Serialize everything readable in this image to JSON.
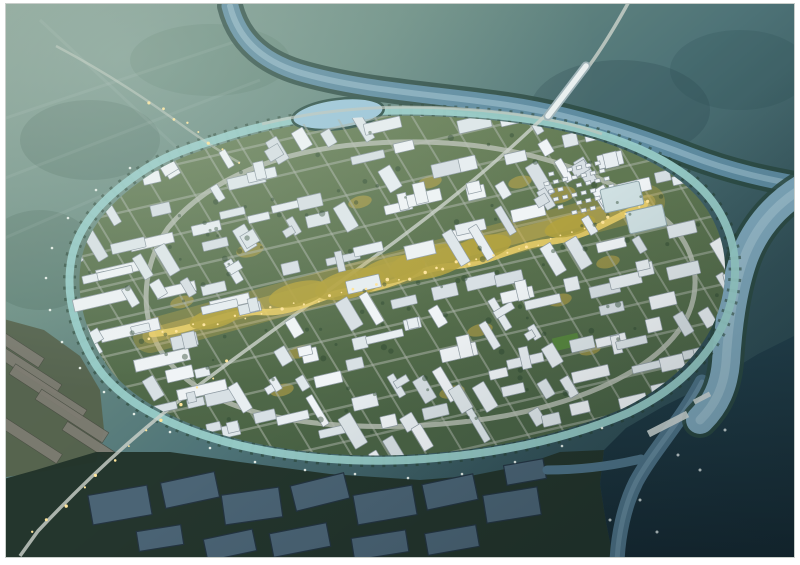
{
  "image": {
    "type": "architectural aerial rendering (photo-style, no text or UI elements visible)",
    "alt": "Oblique aerial dusk rendering of a master-planned city district: an oval island of dense white mid-rise blocks ringed by a canal and ring road, a glowing golden landscaped axis through the center, a winding river with a lake to the north, hazy green farmland to the northwest, a straight highway crossing diagonally with a bridge, greenhouse strips to the southwest, dark aquaculture ponds to the south, and a dark river delta with a pier to the southeast.",
    "visible_text": "none"
  },
  "colors": {
    "frame": "#ffffff",
    "haze_nw": "#86a093",
    "haze_mid": "#5d8180",
    "water_ne": "#36575e",
    "water_se": "#1e3741",
    "river": "#5e8ba0",
    "river_light": "#9dc0cd",
    "river_bank": "#2b4a42",
    "channel": "#4e7388",
    "canal": "#98ccc8",
    "city_green_n": "#6b8259",
    "city_green_s": "#4a6345",
    "building": "#e8eef1",
    "building_shadow": "#8f9ba3",
    "road": "#aab2a7",
    "ring_road": "#b6bdb2",
    "axis_gold": "#c9ab45",
    "axis_bright": "#ecd06a",
    "lawn_olive": "#b3a23e",
    "tree": "#2c4731",
    "pond": "#4e6779",
    "pond_dark": "#243442",
    "field_gray": "#7e7c72",
    "land_dark": "#22332a",
    "light_dot": "#ffe59b"
  },
  "scene": {
    "regions": [
      {
        "name": "farmland-haze-northwest",
        "description": "hazy sage-green fields fading into mist"
      },
      {
        "name": "north-river",
        "description": "steel-blue river winding left-to-right above the city, with a small lake at the city's north edge"
      },
      {
        "name": "city-island",
        "description": "oval planned district of white low-rise blocks on a rotated street grid"
      },
      {
        "name": "golden-axis",
        "description": "illuminated gold-and-olive landscaped spine crossing the city diagonally"
      },
      {
        "name": "ring-road-and-canal",
        "description": "light gray loop road inside a teal canal ring with street lamps"
      },
      {
        "name": "diagonal-highway",
        "description": "straight lit highway from top-right, bridging the river, exiting bottom-left"
      },
      {
        "name": "greenhouse-fields-southwest",
        "description": "gray diagonal greenhouse strips on olive ground"
      },
      {
        "name": "aquaculture-ponds-south",
        "description": "slate-blue rectangular ponds amid dark vegetation"
      },
      {
        "name": "river-delta-southeast",
        "description": "dark water with a lighter channel, small pier and boats"
      }
    ],
    "render": {
      "seed": 11,
      "city_center": [
        402,
        288
      ],
      "grid_angle_u": -13,
      "grid_angle_v": 59,
      "grid_halfU": 360,
      "grid_stepU": 27,
      "grid_halfV": 175,
      "grid_stepV": 31,
      "skip_chance": 0.3,
      "axis_line_pt": [
        400,
        278
      ],
      "axis_normal": [
        0.26,
        0.966
      ],
      "axis_gap": 17,
      "building_fills": [
        "#e8eef1",
        "#dfe7ea",
        "#f0f4f6",
        "#d8e0e4"
      ],
      "road_lines_u": {
        "count": 13,
        "spacing": 36,
        "len": 400,
        "width": 2.4
      },
      "road_lines_v": {
        "count": 23,
        "spacing": 34,
        "len": 250,
        "width": 2.0
      },
      "tree_count": 170,
      "axis_path": [
        [
          150,
          336
        ],
        [
          262,
          312
        ],
        [
          358,
          290
        ],
        [
          452,
          266
        ],
        [
          548,
          242
        ],
        [
          648,
          202
        ]
      ],
      "axis_light_count": 42,
      "axis_patches": [
        [
          215,
          318,
          26,
          10
        ],
        [
          298,
          294,
          30,
          12
        ],
        [
          392,
          270,
          34,
          13
        ],
        [
          482,
          248,
          30,
          12
        ],
        [
          570,
          226,
          26,
          10
        ],
        [
          430,
          262,
          42,
          16
        ],
        [
          350,
          284,
          36,
          14
        ]
      ],
      "gold_pockets": [
        [
          250,
          250,
          14,
          7
        ],
        [
          182,
          302,
          12,
          6
        ],
        [
          300,
          352,
          13,
          6
        ],
        [
          480,
          330,
          13,
          6
        ],
        [
          560,
          300,
          12,
          6
        ],
        [
          608,
          262,
          12,
          6
        ],
        [
          520,
          182,
          12,
          6
        ],
        [
          430,
          182,
          12,
          6
        ],
        [
          360,
          202,
          12,
          6
        ],
        [
          282,
          390,
          12,
          6
        ],
        [
          452,
          392,
          13,
          6
        ],
        [
          590,
          350,
          11,
          5
        ],
        [
          560,
          195,
          16,
          8
        ]
      ],
      "slabs": [
        [
          100,
          300,
          54,
          12
        ],
        [
          130,
          330,
          60,
          12
        ],
        [
          162,
          360,
          56,
          12
        ],
        [
          120,
          270,
          48,
          10
        ],
        [
          152,
          242,
          44,
          10
        ],
        [
          202,
          390,
          50,
          11
        ],
        [
          230,
          302,
          40,
          10
        ],
        [
          176,
          290,
          40,
          10
        ],
        [
          420,
          250,
          30,
          14
        ],
        [
          460,
          235,
          26,
          12
        ]
      ],
      "glass_complexes": [
        [
          622,
          197,
          40,
          24
        ],
        [
          646,
          219,
          38,
          22
        ]
      ],
      "mini_cluster": {
        "x": 542,
        "y": 176,
        "cols": 7,
        "rows": 6,
        "du": 9.5,
        "dv": 9
      },
      "ponds": [
        [
          120,
          505,
          60,
          30,
          -10
        ],
        [
          190,
          490,
          55,
          26,
          -12
        ],
        [
          252,
          506,
          58,
          30,
          -8
        ],
        [
          320,
          492,
          55,
          26,
          -14
        ],
        [
          385,
          505,
          60,
          30,
          -10
        ],
        [
          450,
          492,
          52,
          26,
          -12
        ],
        [
          512,
          505,
          55,
          28,
          -9
        ],
        [
          300,
          540,
          58,
          24,
          -11
        ],
        [
          380,
          545,
          55,
          22,
          -9
        ],
        [
          230,
          545,
          50,
          22,
          -12
        ],
        [
          452,
          540,
          52,
          22,
          -10
        ],
        [
          160,
          538,
          45,
          20,
          -9
        ],
        [
          525,
          472,
          40,
          20,
          -10
        ]
      ],
      "greenhouses": [
        [
          25,
          368,
          80,
          12,
          33
        ],
        [
          48,
          392,
          85,
          12,
          33
        ],
        [
          72,
          416,
          80,
          12,
          33
        ],
        [
          30,
          440,
          70,
          11,
          33
        ],
        [
          90,
          442,
          60,
          10,
          33
        ],
        [
          12,
          344,
          70,
          11,
          33
        ]
      ],
      "canal_lamps": [
        [
          130,
          168
        ],
        [
          96,
          190
        ],
        [
          68,
          218
        ],
        [
          52,
          248
        ],
        [
          46,
          278
        ],
        [
          50,
          310
        ],
        [
          62,
          342
        ],
        [
          80,
          368
        ],
        [
          104,
          392
        ],
        [
          134,
          414
        ],
        [
          170,
          432
        ],
        [
          210,
          448
        ],
        [
          255,
          462
        ],
        [
          305,
          470
        ],
        [
          355,
          474
        ],
        [
          408,
          478
        ],
        [
          462,
          474
        ],
        [
          515,
          462
        ],
        [
          562,
          446
        ],
        [
          602,
          428
        ]
      ],
      "highway_light_path": [
        [
          228,
          362
        ],
        [
          32,
          532
        ]
      ],
      "highway_light_count": 13,
      "nw_light_path": [
        [
          148,
          100
        ],
        [
          236,
          160
        ]
      ],
      "nw_light_count": 8,
      "boats": [
        [
          678,
          455
        ],
        [
          640,
          500
        ],
        [
          657,
          532
        ],
        [
          700,
          470
        ],
        [
          725,
          430
        ],
        [
          610,
          520
        ]
      ],
      "sports_field": [
        566,
        342,
        26,
        13
      ]
    }
  }
}
